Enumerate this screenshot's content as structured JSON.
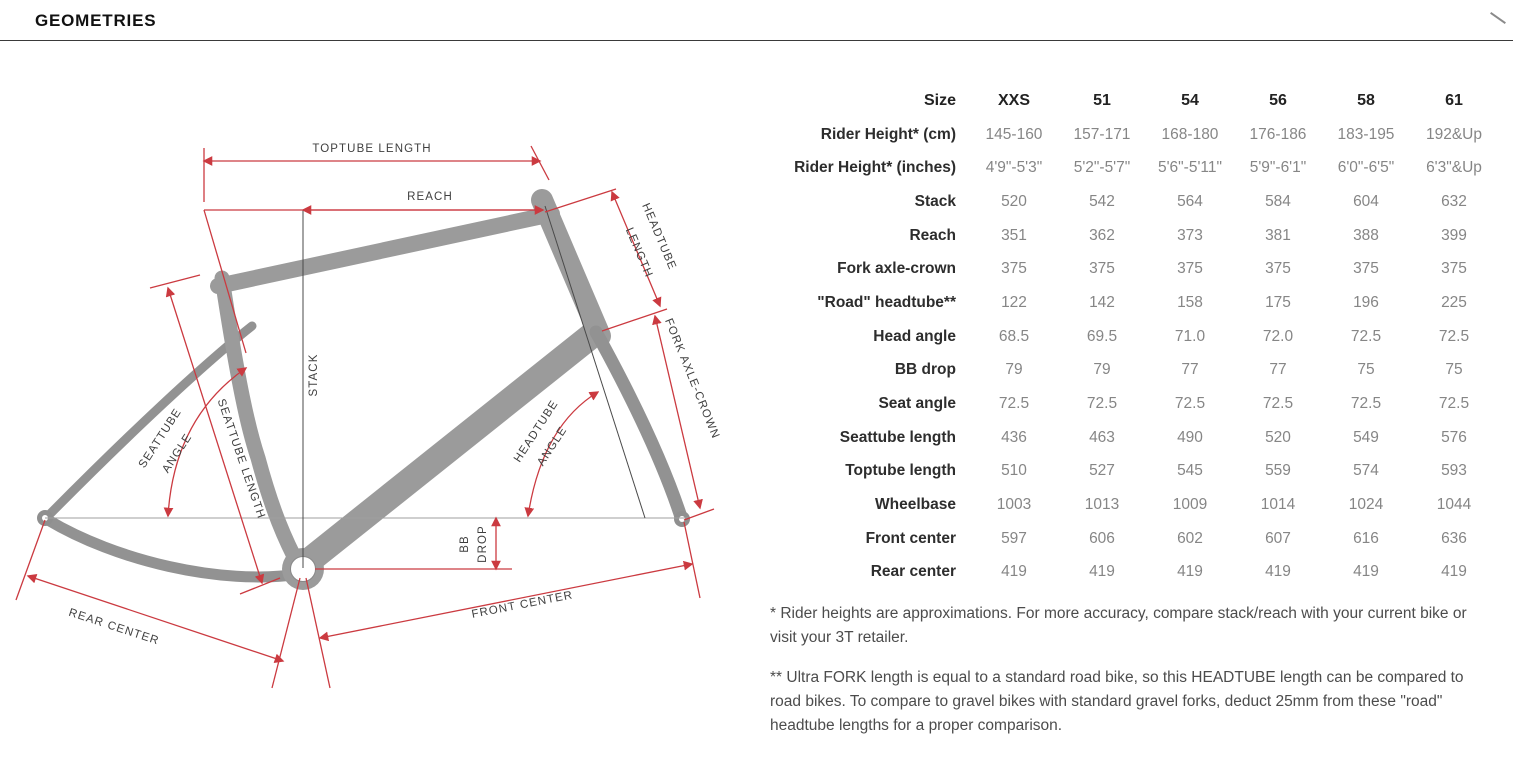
{
  "header": {
    "title": "GEOMETRIES"
  },
  "diagram": {
    "toptube_length": "TOPTUBE LENGTH",
    "reach": "REACH",
    "headtube_length_line1": "HEADTUBE",
    "headtube_length_line2": "LENGTH",
    "stack": "STACK",
    "seattube_angle_line1": "SEATTUBE",
    "seattube_angle_line2": "ANGLE",
    "seattube_length": "SEATTUBE LENGTH",
    "fork_axle_crown": "FORK AXLE-CROWN",
    "headtube_angle_line1": "HEADTUBE",
    "headtube_angle_line2": "ANGLE",
    "bb_drop_line1": "BB",
    "bb_drop_line2": "DROP",
    "rear_center": "REAR CENTER",
    "front_center": "FRONT CENTER"
  },
  "table": {
    "size_label": "Size",
    "sizes": [
      "XXS",
      "51",
      "54",
      "56",
      "58",
      "61"
    ],
    "rows": [
      {
        "label": "Rider Height* (cm)",
        "values": [
          "145-160",
          "157-171",
          "168-180",
          "176-186",
          "183-195",
          "192&Up"
        ]
      },
      {
        "label": "Rider Height* (inches)",
        "values": [
          "4'9\"-5'3\"",
          "5'2\"-5'7\"",
          "5'6\"-5'11\"",
          "5'9\"-6'1\"",
          "6'0\"-6'5\"",
          "6'3\"&Up"
        ]
      },
      {
        "label": "Stack",
        "values": [
          "520",
          "542",
          "564",
          "584",
          "604",
          "632"
        ]
      },
      {
        "label": "Reach",
        "values": [
          "351",
          "362",
          "373",
          "381",
          "388",
          "399"
        ]
      },
      {
        "label": "Fork axle-crown",
        "values": [
          "375",
          "375",
          "375",
          "375",
          "375",
          "375"
        ]
      },
      {
        "label": "\"Road\" headtube**",
        "values": [
          "122",
          "142",
          "158",
          "175",
          "196",
          "225"
        ]
      },
      {
        "label": "Head angle",
        "values": [
          "68.5",
          "69.5",
          "71.0",
          "72.0",
          "72.5",
          "72.5"
        ]
      },
      {
        "label": "BB drop",
        "values": [
          "79",
          "79",
          "77",
          "77",
          "75",
          "75"
        ]
      },
      {
        "label": "Seat angle",
        "values": [
          "72.5",
          "72.5",
          "72.5",
          "72.5",
          "72.5",
          "72.5"
        ]
      },
      {
        "label": "Seattube length",
        "values": [
          "436",
          "463",
          "490",
          "520",
          "549",
          "576"
        ]
      },
      {
        "label": "Toptube length",
        "values": [
          "510",
          "527",
          "545",
          "559",
          "574",
          "593"
        ]
      },
      {
        "label": "Wheelbase",
        "values": [
          "1003",
          "1013",
          "1009",
          "1014",
          "1024",
          "1044"
        ]
      },
      {
        "label": "Front center",
        "values": [
          "597",
          "606",
          "602",
          "607",
          "616",
          "636"
        ]
      },
      {
        "label": "Rear center",
        "values": [
          "419",
          "419",
          "419",
          "419",
          "419",
          "419"
        ]
      }
    ]
  },
  "footnotes": [
    "* Rider heights are approximations. For more accuracy, compare stack/reach with your current bike or visit your 3T retailer.",
    "** Ultra FORK length is equal to a standard road bike, so this HEADTUBE length can be compared to road bikes. To compare to gravel bikes with standard gravel forks, deduct 25mm from these \"road\" headtube lengths for a proper comparison."
  ],
  "colors": {
    "dimension_red": "#cb3a40",
    "frame_gray": "#9b9b9b",
    "label_dark": "#3f3f3f",
    "value_gray": "#868686"
  }
}
